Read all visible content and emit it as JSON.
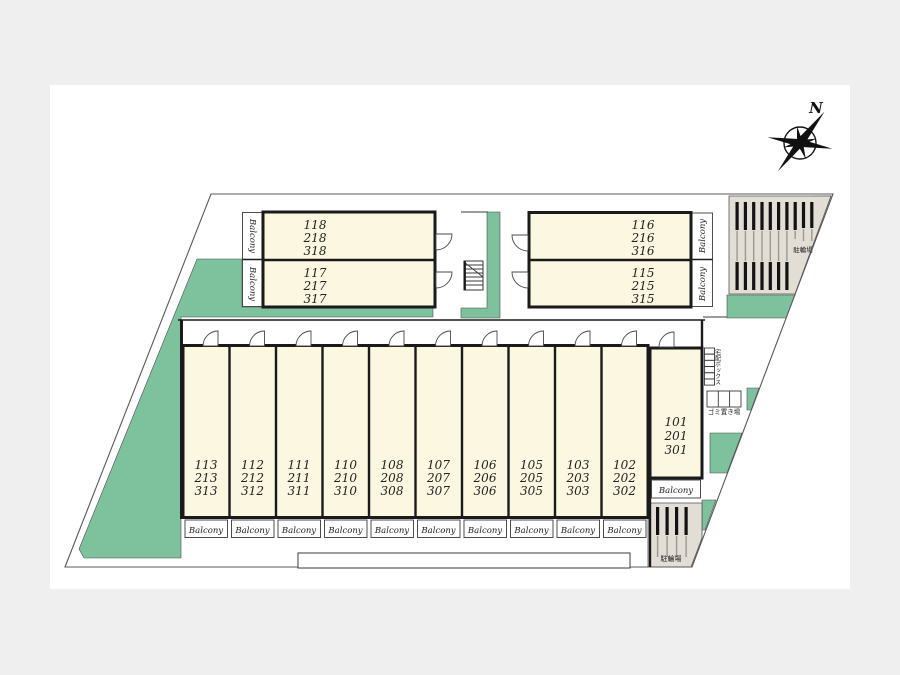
{
  "colors": {
    "background": "#efefef",
    "paper": "#ffffff",
    "room_fill": "#fbf7e1",
    "landscaping_green": "#7dc29c",
    "bike_area_gray": "#e2ded5",
    "wall": "#1a1a1a"
  },
  "compass": {
    "north_label": "N"
  },
  "balcony_label": "Balcony",
  "blocks": {
    "upper_left": {
      "rooms": [
        {
          "lines": [
            "118",
            "218",
            "318"
          ]
        },
        {
          "lines": [
            "117",
            "217",
            "317"
          ]
        }
      ]
    },
    "upper_right": {
      "rooms": [
        {
          "lines": [
            "116",
            "216",
            "316"
          ]
        },
        {
          "lines": [
            "115",
            "215",
            "315"
          ]
        }
      ]
    },
    "main_row": {
      "rooms": [
        {
          "lines": [
            "113",
            "213",
            "313"
          ]
        },
        {
          "lines": [
            "112",
            "212",
            "312"
          ]
        },
        {
          "lines": [
            "111",
            "211",
            "311"
          ]
        },
        {
          "lines": [
            "110",
            "210",
            "310"
          ]
        },
        {
          "lines": [
            "108",
            "208",
            "308"
          ]
        },
        {
          "lines": [
            "107",
            "207",
            "307"
          ]
        },
        {
          "lines": [
            "106",
            "206",
            "306"
          ]
        },
        {
          "lines": [
            "105",
            "205",
            "305"
          ]
        },
        {
          "lines": [
            "103",
            "203",
            "303"
          ]
        },
        {
          "lines": [
            "102",
            "202",
            "302"
          ]
        }
      ]
    },
    "east_end": {
      "room": {
        "lines": [
          "101",
          "201",
          "301"
        ]
      }
    }
  },
  "facilities": {
    "bicycle_parking_north": "駐輪場",
    "bicycle_parking_south": "駐輪場",
    "delivery_box": "宅配ボックス",
    "garbage_area": "ゴミ置き場"
  }
}
